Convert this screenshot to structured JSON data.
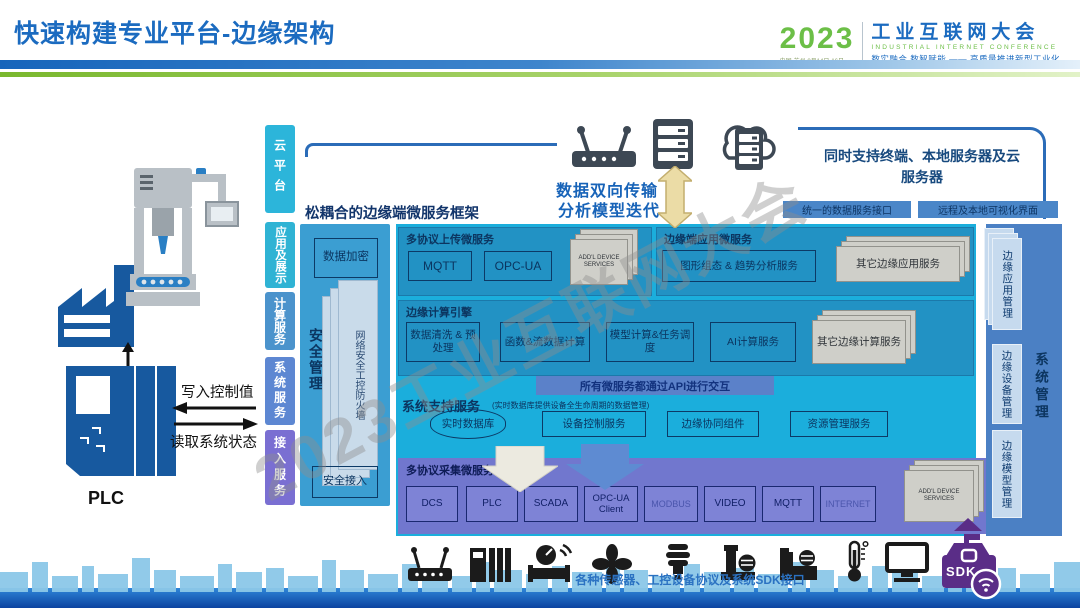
{
  "slide": {
    "title": "快速构建专业平台-边缘架构"
  },
  "logo": {
    "year": "2023",
    "venue": "中国·苏州 8月14日-16日",
    "name_cn": "工业互联网大会",
    "name_en": "INDUSTRIAL INTERNET CONFERENCE",
    "tagline": "数实融合 数智赋能 —— 高质量推进新型工业化"
  },
  "watermark": "2023工业互联网大会",
  "left_scene": {
    "plc_label": "PLC",
    "write_label": "写入控制值",
    "read_label": "读取系统状态"
  },
  "layer_bars": [
    "云平台",
    "应用及展示",
    "计算服务",
    "系统服务",
    "接入服务"
  ],
  "top_area": {
    "transfer_line1": "数据双向传输",
    "transfer_line2": "分析模型迭代",
    "support_note": "同时支持终端、本地服务器及云服务器",
    "bar_left": "统一的数据服务接口",
    "bar_right": "远程及本地可视化界面"
  },
  "framework": {
    "title": "松耦合的边缘端微服务框架",
    "security": {
      "encrypt": "数据加密",
      "manage": "安全管理",
      "firewall": "网络安全工控防火墙",
      "access": "安全接入"
    },
    "upload": {
      "label": "多协议上传微服务",
      "items": [
        "MQTT",
        "OPC-UA"
      ],
      "more": "ADD'L DEVICE SERVICES"
    },
    "edge_app": {
      "label": "边缘端应用微服务",
      "item": "图形组态 & 趋势分析服务",
      "more": "其它边缘应用服务"
    },
    "compute": {
      "label": "边缘计算引擎",
      "items": [
        "数据清洗 & 预处理",
        "函数&流数据计算",
        "模型计算&任务调度",
        "AI计算服务"
      ],
      "more": "其它边缘计算服务"
    },
    "api_bar": "所有微服务都通过API进行交互",
    "support": {
      "label": "系统支持服务",
      "note": "(实时数据库提供设备全生命周期的数据管理)",
      "items": [
        "实时数据库",
        "设备控制服务",
        "边缘协同组件",
        "资源管理服务"
      ]
    },
    "collect": {
      "label": "多协议采集微服务",
      "items": [
        "DCS",
        "PLC",
        "SCADA",
        "OPC-UA Client",
        "MODBUS",
        "VIDEO",
        "MQTT",
        "INTERNET"
      ],
      "more": "ADD'L DEVICE SERVICES"
    }
  },
  "management": {
    "label": "系统管理",
    "items": [
      "边缘应用管理",
      "边缘设备管理",
      "边缘模型管理"
    ]
  },
  "bottom": {
    "caption": "各种传感器、工控设备协议及系统SDK接口",
    "sdk_label": "SDK"
  },
  "colors": {
    "accent_blue": "#1B6BC0",
    "accent_green": "#7AB82E",
    "cyan_panel": "#1BAEDC",
    "purple_panel": "#7177CE",
    "management_panel": "#4B80C4",
    "sdk_purple": "#5A2D87"
  }
}
